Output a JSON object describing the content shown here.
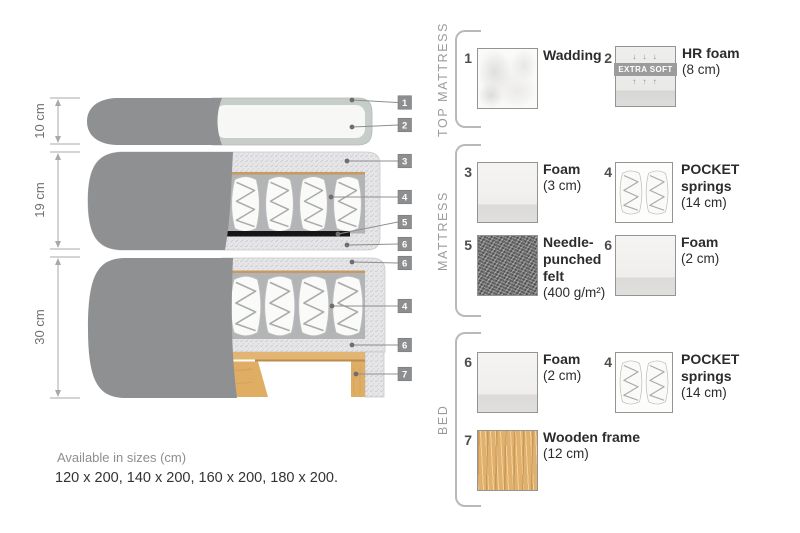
{
  "diagram": {
    "measurements": [
      {
        "label": "10 cm"
      },
      {
        "label": "19 cm"
      },
      {
        "label": "30 cm"
      }
    ],
    "callouts": [
      "1",
      "2",
      "3",
      "4",
      "5",
      "6",
      "6",
      "4",
      "6",
      "7"
    ]
  },
  "legend": {
    "sections": [
      {
        "title": "TOP MATTRESS",
        "items": [
          {
            "num": "1",
            "name": "Wadding",
            "detail": ""
          },
          {
            "num": "2",
            "name": "HR foam",
            "detail": "(8 cm)",
            "badge": "EXTRA SOFT",
            "arrows_down": "↓ ↓ ↓",
            "arrows_up": "↑ ↑ ↑"
          }
        ]
      },
      {
        "title": "MATTRESS",
        "items": [
          {
            "num": "3",
            "name": "Foam",
            "detail": "(3 cm)"
          },
          {
            "num": "4",
            "name": "POCKET springs",
            "detail": "(14 cm)"
          },
          {
            "num": "5",
            "name": "Needle-punched felt",
            "detail": "(400 g/m²)"
          },
          {
            "num": "6",
            "name": "Foam",
            "detail": "(2 cm)"
          }
        ]
      },
      {
        "title": "BED",
        "items": [
          {
            "num": "6",
            "name": "Foam",
            "detail": "(2 cm)"
          },
          {
            "num": "4",
            "name": "POCKET springs",
            "detail": "(14 cm)"
          },
          {
            "num": "7",
            "name": "Wooden frame",
            "detail": "(12 cm)"
          }
        ]
      }
    ]
  },
  "footer": {
    "sizes_title": "Available in sizes (cm)",
    "sizes_list": "120 x 200, 140 x 200, 160 x 200, 180 x 200."
  },
  "colors": {
    "fabric_gray": "#8f9092",
    "foam_speckle": "#e6e6e8",
    "quilt_border": "#c7cec9",
    "felt_dark": "#767676",
    "wood": "#e0b06c",
    "tag_gray": "#8d8e90",
    "tan_line": "#c89a5f"
  }
}
